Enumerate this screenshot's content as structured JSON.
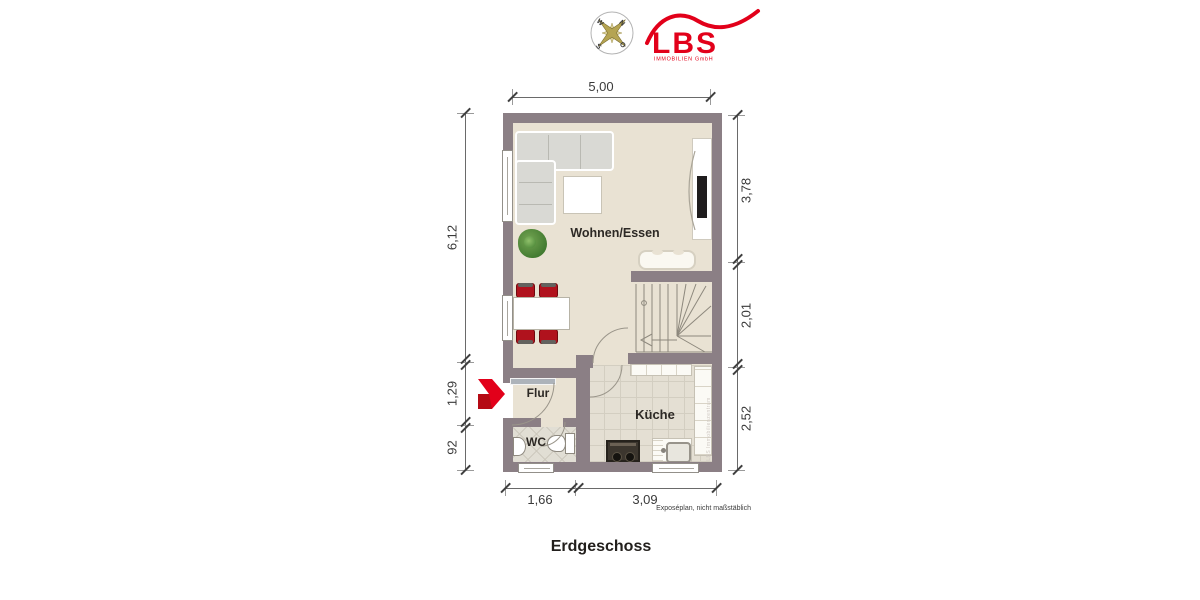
{
  "header": {
    "compass": {
      "n": "N",
      "e": "O",
      "s": "S",
      "w": "W"
    },
    "logo": {
      "brand": "LBS",
      "subtitle": "IMMOBILIEN GmbH"
    }
  },
  "plan": {
    "rooms": {
      "living": "Wohnen/Essen",
      "hall": "Flur",
      "kitchen": "Küche",
      "wc": "WC"
    },
    "watermark": "LBS Immobilienzentrum"
  },
  "dimensions": {
    "top": "5,00",
    "left": [
      "6,12",
      "1,29",
      "92"
    ],
    "right": [
      "3,78",
      "2,01",
      "2,52"
    ],
    "bottom": [
      "1,66",
      "3,09"
    ]
  },
  "footnote": "Exposéplan, nicht maßstäblich",
  "title": "Erdgeschoss",
  "colors": {
    "wall": "#8b7f85",
    "floor": "#e9e2d3",
    "accent": "#e2001a"
  }
}
